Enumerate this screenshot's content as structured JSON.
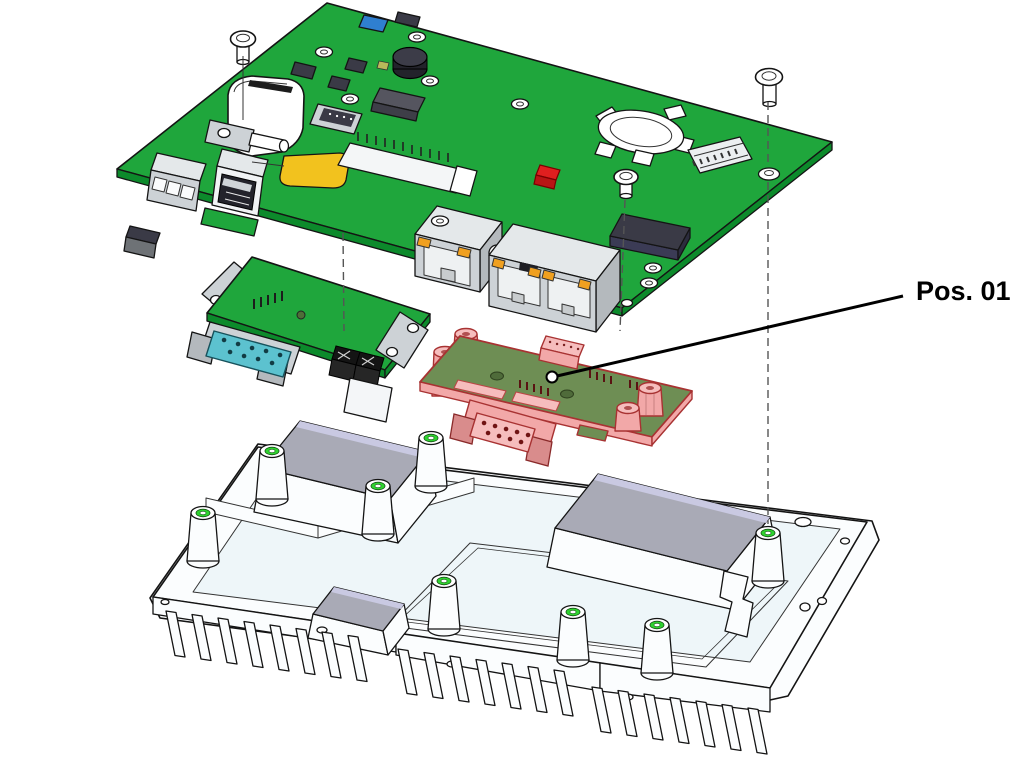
{
  "callout": {
    "label": "Pos. 01"
  },
  "colors": {
    "pcb_green": "#1fa63c",
    "pcb_green_dark": "#0c8a2b",
    "pcb_olive": "#6e8e54",
    "highlight_pink": "#f2a8a8",
    "highlight_pink_light": "#f6bdbd",
    "highlight_outline": "#a83232",
    "db9_teal": "#5cc2cf",
    "metal_light": "#e4e8ea",
    "metal_mid": "#cdd2d6",
    "metal_dark": "#b4b9bd",
    "chip_dark": "#3a3a46",
    "chip_side": "#2c2c3e",
    "component_yellow": "#f2c21e",
    "component_blue": "#2f7fd0",
    "led_orange": "#f0a020",
    "buzzer_black": "#23232b",
    "pad_gray": "#a9aab6",
    "pad_edge_lavender": "#c9c9e2",
    "chassis_fill": "#fbfdfe",
    "chassis_recess": "#eef6f9",
    "standoff_green": "#2fd32f",
    "line_dark": "#141414",
    "dash_gray": "#555555"
  }
}
